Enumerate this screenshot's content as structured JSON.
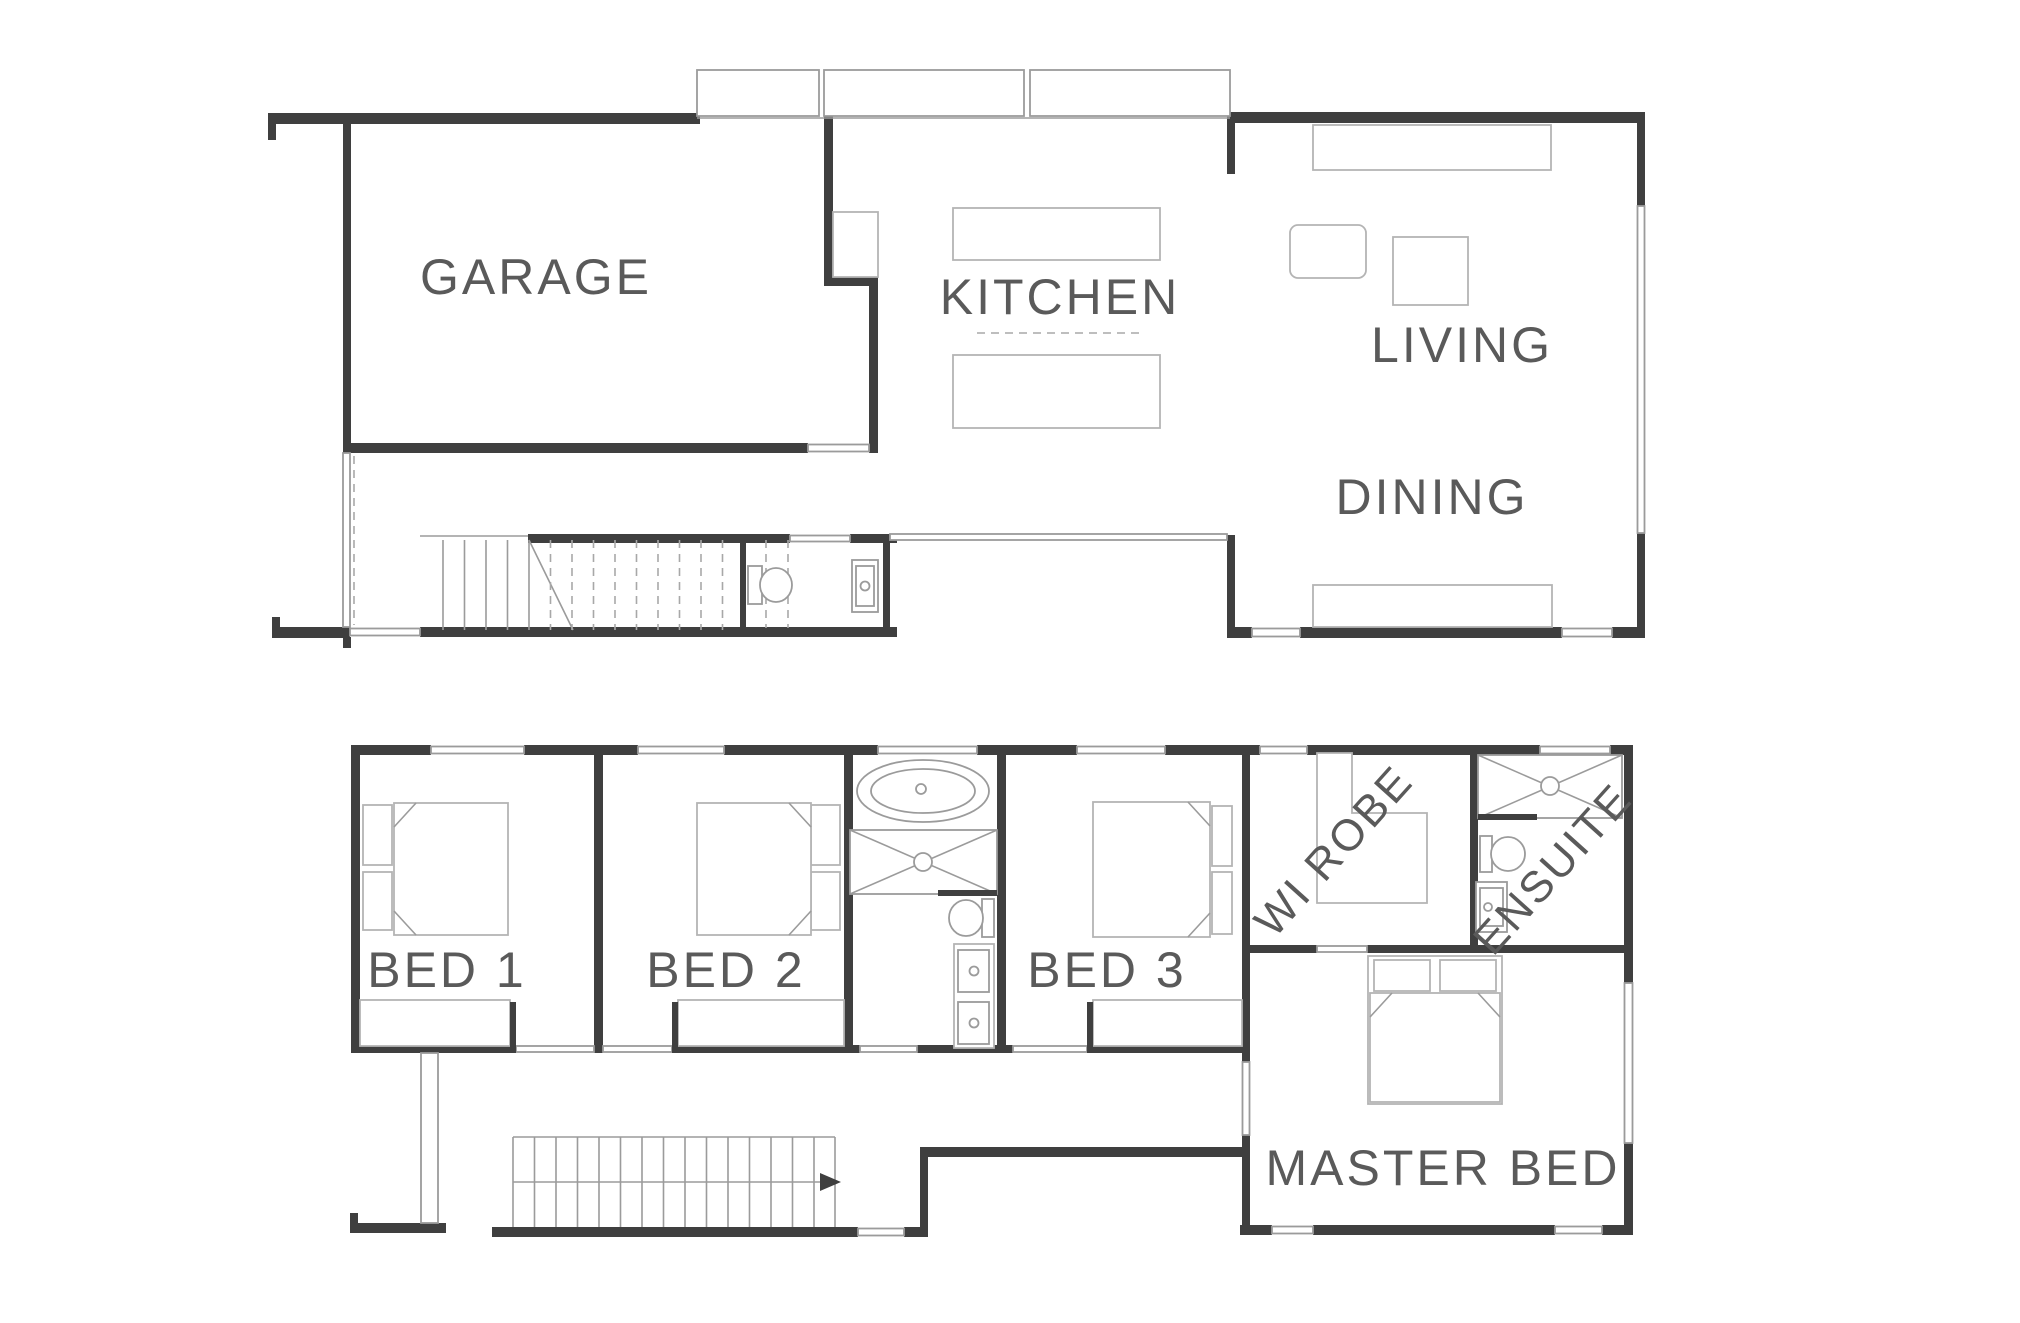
{
  "title": "Two storey house floor plan",
  "colors": {
    "background": "#ffffff",
    "wall": "#3f3f3f",
    "window_line": "#9b9b9b",
    "furniture_line": "#b4b4b4",
    "label_text": "#5a5a5a"
  },
  "ground_floor": {
    "name": "ground-floor",
    "rooms": [
      {
        "id": "garage",
        "label": "GARAGE"
      },
      {
        "id": "kitchen",
        "label": "KITCHEN"
      },
      {
        "id": "living",
        "label": "LIVING"
      },
      {
        "id": "dining",
        "label": "DINING"
      }
    ],
    "fixtures": [
      "staircase",
      "wc-toilet",
      "wc-basin",
      "kitchen-island",
      "kitchen-bench",
      "pantry",
      "tv-unit",
      "side-table",
      "coffee-table",
      "sideboard",
      "window-bays"
    ]
  },
  "upper_floor": {
    "name": "upper-floor",
    "rooms": [
      {
        "id": "bed1",
        "label": "BED 1"
      },
      {
        "id": "bed2",
        "label": "BED 2"
      },
      {
        "id": "bed3",
        "label": "BED 3"
      },
      {
        "id": "wirobe",
        "label": "WI ROBE"
      },
      {
        "id": "ensuite",
        "label": "ENSUITE"
      },
      {
        "id": "master",
        "label": "MASTER BED"
      }
    ],
    "fixtures": [
      "staircase",
      "direction-arrow",
      "bathtub",
      "shower",
      "toilet",
      "double-vanity",
      "ensuite-shower",
      "ensuite-toilet",
      "ensuite-vanity",
      "beds",
      "wardrobes",
      "walk-in-robe-shelving"
    ]
  }
}
